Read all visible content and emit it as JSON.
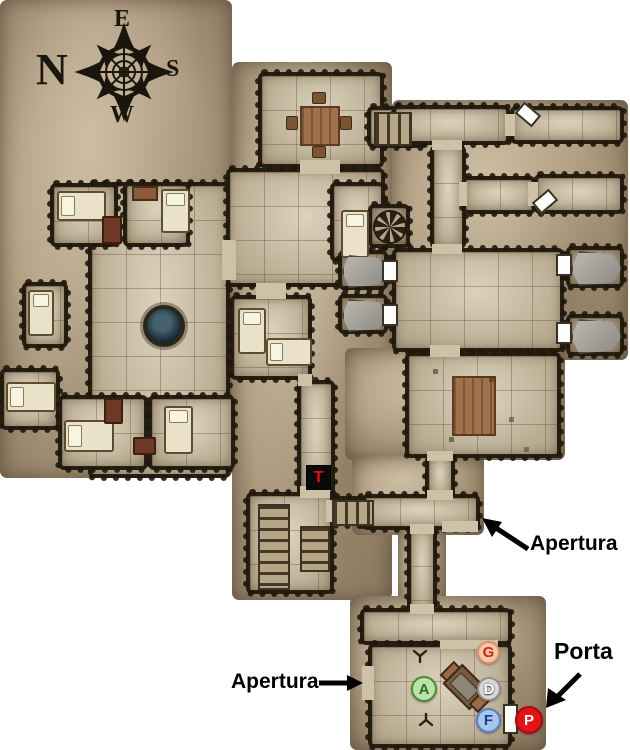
{
  "compass": {
    "north": "N",
    "east": "E",
    "south": "S",
    "west": "W"
  },
  "labels": {
    "apertura_top": "Apertura",
    "apertura_bottom": "Apertura",
    "porta": "Porta"
  },
  "markers": {
    "trap": {
      "letter": "T",
      "bg": "#0c0a08",
      "color": "#e01319"
    },
    "tokens": {
      "g": {
        "letter": "G",
        "bg": "#f5c8a4",
        "border": "#dd9070",
        "color": "#cf2128"
      },
      "a": {
        "letter": "A",
        "bg": "#bce2ab",
        "border": "#4a8c38",
        "color": "#2e701f"
      },
      "d": {
        "letter": "D",
        "bg": "#d8d8d5",
        "border": "#90908c",
        "color": "#ffffff"
      },
      "f": {
        "letter": "F",
        "bg": "#a9c5ee",
        "border": "#5a7ec0",
        "color": "#1e3b8e"
      },
      "p": {
        "letter": "P",
        "bg": "#e21319",
        "border": "#a30d12",
        "color": "#ffffff"
      }
    }
  }
}
